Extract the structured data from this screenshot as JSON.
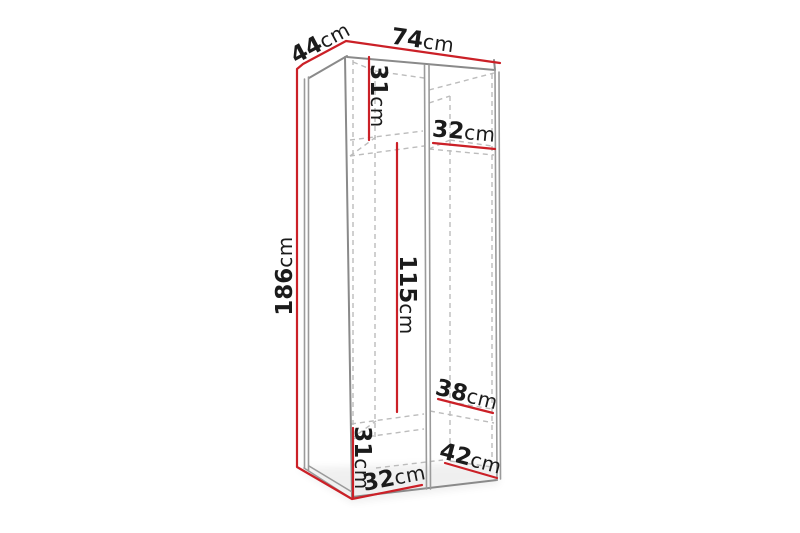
{
  "page": {
    "background_color": "#ffffff",
    "content": "furniture dimension diagram of an open two-section wardrobe frame shown in perspective"
  },
  "diagram": {
    "type": "dimension-diagram",
    "unit": "cm",
    "colors": {
      "dimension_line": "#cb2027",
      "visible_edge": "#8a8a8a",
      "hidden_edge": "#bcbcbc",
      "label_text": "#1b1b1b",
      "background": "#ffffff"
    },
    "dimensions": [
      {
        "id": "top-depth",
        "value": "44",
        "unit": "cm"
      },
      {
        "id": "top-width",
        "value": "74",
        "unit": "cm"
      },
      {
        "id": "upper-left-section-height",
        "value": "31",
        "unit": "cm"
      },
      {
        "id": "upper-right-shelf-width",
        "value": "32",
        "unit": "cm"
      },
      {
        "id": "overall-height",
        "value": "186",
        "unit": "cm"
      },
      {
        "id": "hanging-section-height",
        "value": "115",
        "unit": "cm"
      },
      {
        "id": "right-shelf-depth",
        "value": "38",
        "unit": "cm"
      },
      {
        "id": "lower-left-section-height",
        "value": "31",
        "unit": "cm"
      },
      {
        "id": "lower-left-section-width",
        "value": "32",
        "unit": "cm"
      },
      {
        "id": "lower-right-section-depth",
        "value": "42",
        "unit": "cm"
      }
    ]
  }
}
